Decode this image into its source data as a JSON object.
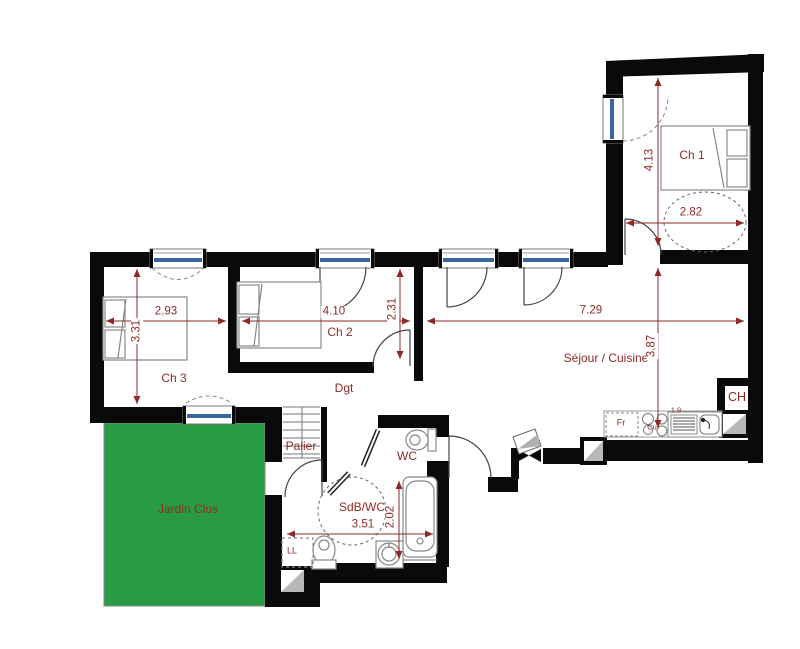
{
  "floor_plan": {
    "rooms": {
      "ch1": "Ch 1",
      "ch2": "Ch 2",
      "ch3": "Ch 3",
      "dgt": "Dgt",
      "sejour_cuisine": "Séjour / Cuisine",
      "wc": "WC",
      "sdb_wc": "SdB/WC",
      "palier": "Palier",
      "jardin_clos": "Jardin Clos",
      "ch_closet": "CH"
    },
    "dimensions_m": {
      "ch1_height": "4.13",
      "ch1_width": "2.82",
      "ch3_width": "2.93",
      "ch3_height": "3.31",
      "ch2_width": "4.10",
      "dgt_depth": "2.31",
      "sejour_width": "7.29",
      "sejour_height": "3.87",
      "sdb_width": "3.51",
      "sdb_height": "2.02",
      "counter": "1.9"
    },
    "fixtures": {
      "fridge": "Fr",
      "cooktop": "Cu",
      "washing_machine": "LL"
    },
    "colors": {
      "wall": "#0a0a0a",
      "annotation_red": "#8e2a26",
      "garden_green": "#2a9b45",
      "window_glazing": "#3a66a0"
    }
  }
}
